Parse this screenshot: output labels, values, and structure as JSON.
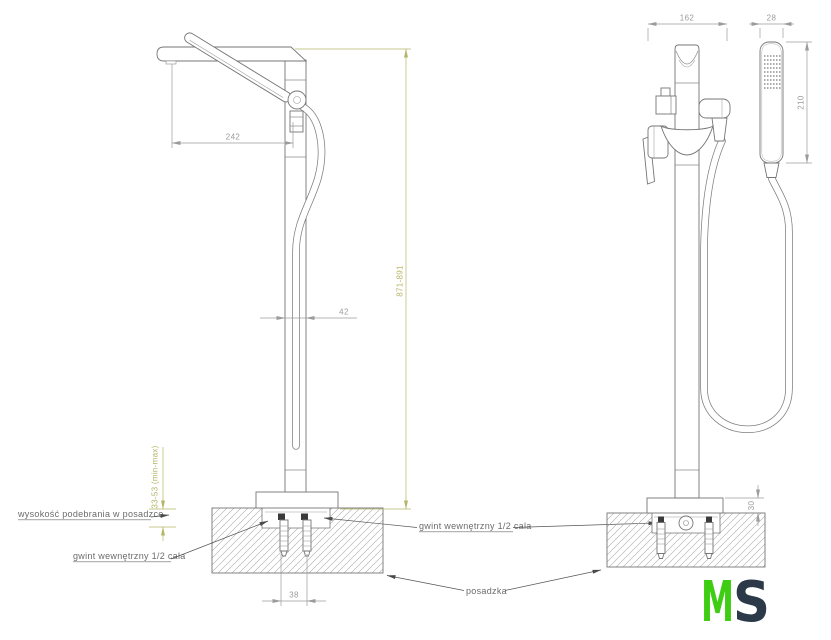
{
  "drawing": {
    "product": "freestanding bathtub mixer with hand shower - dimension drawing",
    "views": {
      "side": "side-view",
      "front": "front-view"
    }
  },
  "dims": {
    "spout_reach": "242",
    "column_depth": "42",
    "height_range": "871-891",
    "anchor_spacing": "38",
    "undercut_range": "33-53 (min-max)",
    "body_width": "162",
    "handset_width": "28",
    "handset_length": "210",
    "flange_height": "30"
  },
  "labels": {
    "undercut_note": "wysokość podebrania w posadzce",
    "thread_note_left": "gwint wewnętrzny 1/2 cala",
    "thread_note_right": "gwint wewnętrzny 1/2 cala",
    "floor_note": "posadzka"
  },
  "logo": {
    "letter_m": "M",
    "letter_s": "S",
    "m_color": "#3ecd12",
    "s_color": "#2b3949"
  },
  "colors": {
    "outline": "#767676",
    "dimension": "#9b9b9b",
    "accent_dimension": "#b5b566",
    "label": "#6b6b6b"
  }
}
